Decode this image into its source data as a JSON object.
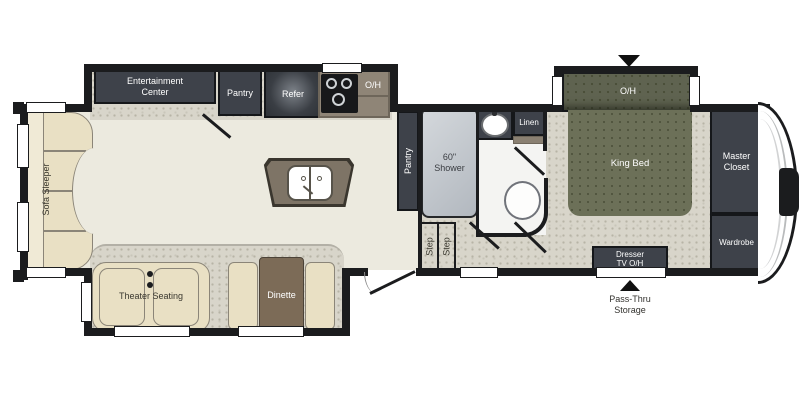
{
  "palette": {
    "wall": "#1B1C1E",
    "main_floor": "#ECEADF",
    "carpet": "#D8D5CA",
    "cabinet_dark": "#3E424A",
    "bed_olive": "#6C7058",
    "bed_overhead_olive": "#5F6350",
    "furniture_beige": "#E9E0C4",
    "sofa_back_beige": "#F0EAD6",
    "table_brown": "#7C6B57",
    "island_taupe": "#7E7466",
    "stove_surround_brown": "#8F8577",
    "shower_gray": "#C9CED3",
    "bath_floor": "#F4F4F2"
  },
  "areas": {
    "sofa_sleeper": {
      "label": "Sofa Sleeper"
    },
    "entertainment_center": {
      "label_line1": "Entertainment",
      "label_line2": "Center"
    },
    "pantry_front": {
      "label": "Pantry"
    },
    "refrigerator": {
      "label": "Refer"
    },
    "kitchen_overhead": {
      "label": "O/H"
    },
    "theater_seating": {
      "label": "Theater Seating"
    },
    "dinette": {
      "label": "Dinette"
    },
    "pantry_hall": {
      "label": "Pantry"
    },
    "shower": {
      "label_line1": "60\"",
      "label_line2": "Shower"
    },
    "linen": {
      "label": "Linen"
    },
    "steps": {
      "step1": "Step",
      "step2": "Step"
    },
    "king_bed": {
      "label": "King Bed"
    },
    "bed_overhead": {
      "label": "O/H"
    },
    "master_closet": {
      "label_line1": "Master",
      "label_line2": "Closet"
    },
    "wardrobe": {
      "label": "Wardrobe"
    },
    "dresser": {
      "label_line1": "Dresser",
      "label_line2": "TV  O/H"
    },
    "pass_thru_storage": {
      "label_line1": "Pass-Thru",
      "label_line2": "Storage"
    }
  }
}
